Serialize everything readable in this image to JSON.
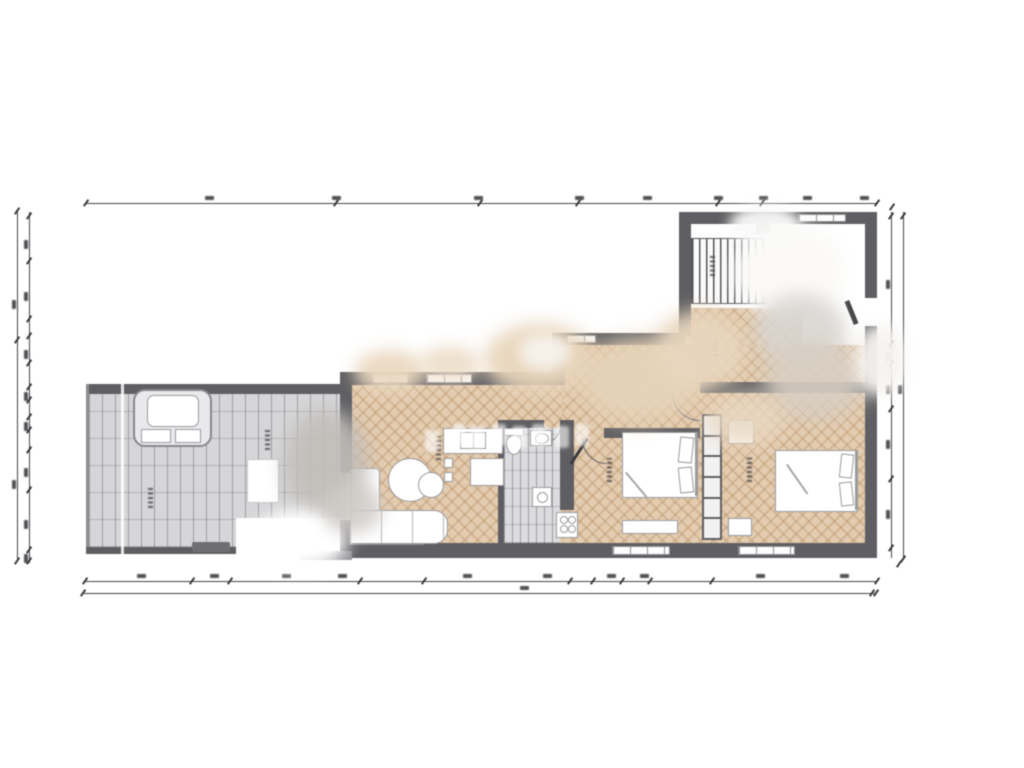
{
  "meta": {
    "type": "architectural-floor-plan",
    "style": "top-down colored plan render, scanned and blurry",
    "background": "#ffffff",
    "all_text_illegible": true
  },
  "palette": {
    "wall": "#5f5f63",
    "wall_light": "#8d8d91",
    "parquet": "#e3ccb0",
    "parquet_grain": "#a97a4a",
    "terrace_tile": "#d6d6d8",
    "tile_line": "#737377",
    "bath_tile": "#dcdcde",
    "furniture_fill": "#ffffff",
    "furniture_line": "#9b9b9f",
    "dimension_line": "#46464a",
    "watermark_white": "#f7f5f2",
    "watermark_beige": "#e8d5bb",
    "watermark_gray": "#c6c2be"
  },
  "rooms": [
    {
      "name": "terrace",
      "floor": "gray tile grid",
      "features": [
        "hot tub",
        "outdoor table",
        "doormat",
        "rotated illegible label"
      ]
    },
    {
      "name": "living-dining-kitchen",
      "floor": "herringbone parquet",
      "features": [
        "corner sofa",
        "round coffee table",
        "dining table with chairs",
        "kitchen counter with sink",
        "kitchen island",
        "appliance with burners"
      ]
    },
    {
      "name": "bathroom",
      "floor": "small gray tile",
      "features": [
        "toilet",
        "washbasin",
        "washing machine"
      ]
    },
    {
      "name": "bedroom-1",
      "floor": "herringbone parquet",
      "features": [
        "double bed with pillows",
        "sideboard",
        "rotated illegible label"
      ]
    },
    {
      "name": "bedroom-2",
      "floor": "herringbone parquet",
      "features": [
        "double bed with pillows",
        "nightstand",
        "sideboard",
        "rotated illegible label"
      ]
    },
    {
      "name": "hallway",
      "floor": "herringbone parquet",
      "features": [
        "built-in wardrobe shelf column",
        "rotated illegible label"
      ]
    },
    {
      "name": "entry",
      "floor": "herringbone parquet",
      "features": [
        "staircase with treads",
        "entrance door in right wall",
        "window in top wall"
      ]
    }
  ],
  "windows": {
    "bottom_wall": 3,
    "top_wall_living": 2,
    "top_wall_hall": 1,
    "entry_top_wall": 1
  },
  "dimension_lines": {
    "top": 1,
    "bottom": 2,
    "left": 2,
    "right": 2,
    "labels": "tiny numeric dimension labels present along every line but blurred beyond legibility"
  },
  "artifacts": {
    "watermark_blobs": "multiple soft white, beige and gray smudges where a watermark was removed (center, entry room, terrace edge)",
    "vertical_crease": "light vertical line across the terrace",
    "ghost_letters": "faint white letter shapes over the kitchen/bathroom area"
  }
}
